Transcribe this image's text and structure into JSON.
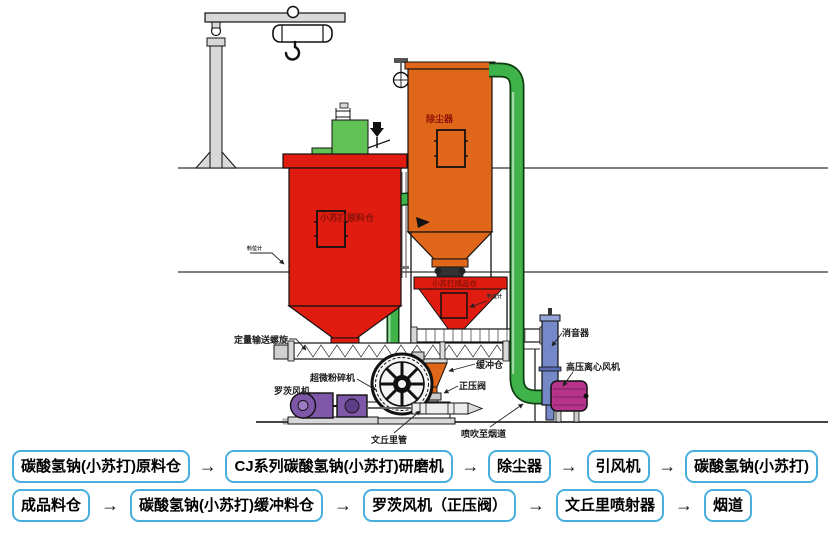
{
  "diagram": {
    "raw_silo_label": "小苏打原料仓",
    "dust_collector_label": "除尘器",
    "product_silo_label": "小苏打成品仓",
    "screw_conveyor_label": "定量输送螺旋",
    "mill_label": "超微粉碎机",
    "roots_blower_label": "罗茨风机",
    "buffer_hopper_label": "缓冲仓",
    "pressure_valve_label": "正压阀",
    "venturi_label": "文丘里管",
    "flue_injection_label": "喷吹至烟道",
    "silencer_label": "消音器",
    "hp_fan_label": "高压离心风机",
    "level_gauge_left_label": "料位计",
    "level_gauge_right_label": "料位计"
  },
  "colors": {
    "silo_red": "#e01c10",
    "collector_orange": "#e0661a",
    "pipe_green": "#3fb24a",
    "equipment_green": "#63c255",
    "blower_purple": "#7e57a9",
    "fan_magenta": "#b5338a",
    "silencer_blue": "#7588c8",
    "flow_border_blue": "#47aede",
    "label_dark_red": "#8b1208"
  },
  "flowchart": {
    "arrow": "→",
    "row1": [
      "碳酸氢钠(小苏打)原料仓",
      "CJ系列碳酸氢钠(小苏打)研磨机",
      "除尘器",
      "引风机",
      "碳酸氢钠(小苏打)"
    ],
    "row2": [
      "成品料仓",
      "碳酸氢钠(小苏打)缓冲料仓",
      "罗茨风机（正压阀）",
      "文丘里喷射器",
      "烟道"
    ]
  }
}
